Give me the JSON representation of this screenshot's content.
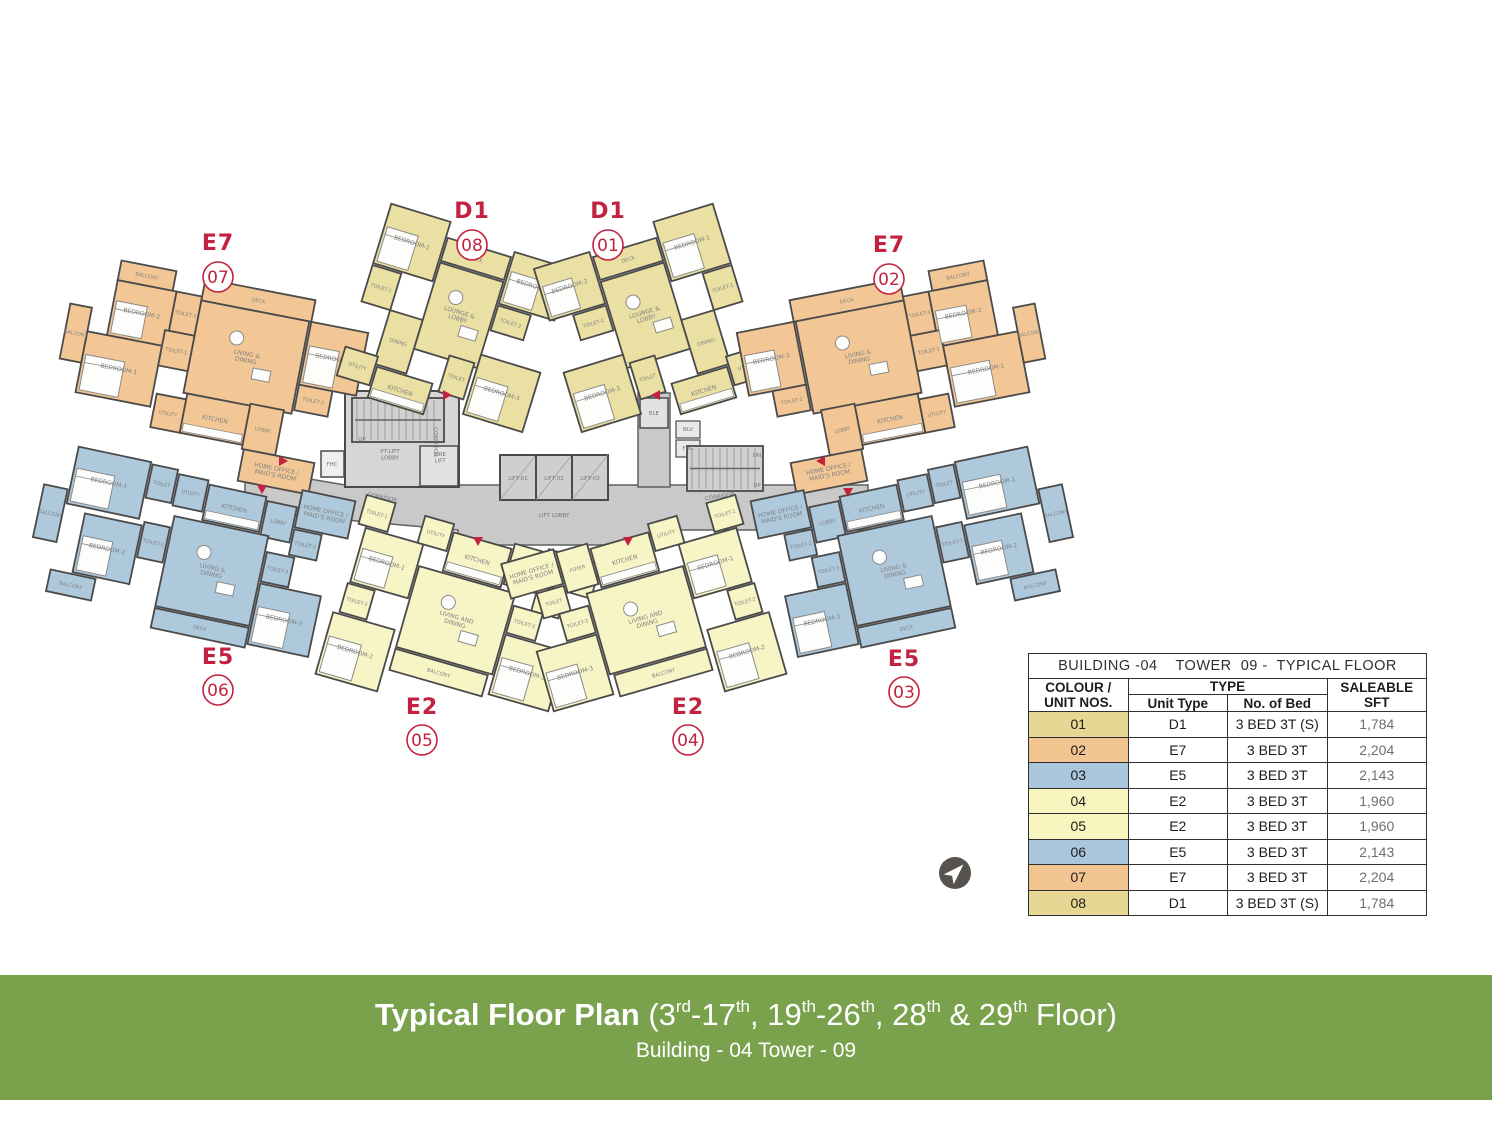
{
  "banner": {
    "bg": "#7aa24d",
    "heading_bold": "Typical Floor Plan ",
    "heading_parts": [
      {
        "t": "(3"
      },
      {
        "sup": "rd"
      },
      {
        "t": "-17"
      },
      {
        "sup": "th"
      },
      {
        "t": ", 19"
      },
      {
        "sup": "th"
      },
      {
        "t": "-26"
      },
      {
        "sup": "th"
      },
      {
        "t": ", 28"
      },
      {
        "sup": "th"
      },
      {
        "t": " & 29"
      },
      {
        "sup": "th"
      },
      {
        "t": " Floor)"
      }
    ],
    "subtitle": "Building - 04 Tower - 09"
  },
  "table": {
    "title": "BUILDING -04    TOWER  09 -  TYPICAL FLOOR",
    "header": {
      "col1_line1": "COLOUR /",
      "col1_line2": "UNIT NOS.",
      "type_group": "TYPE",
      "unit_type": "Unit Type",
      "no_of_bed": "No. of Bed",
      "saleable_line1": "SALEABLE",
      "saleable_line2": "SFT"
    },
    "rows": [
      {
        "unit": "01",
        "color": "#e7d795",
        "type": "D1",
        "bed": "3 BED 3T (S)",
        "sft": "1,784"
      },
      {
        "unit": "02",
        "color": "#f2c48f",
        "type": "E7",
        "bed": "3 BED 3T",
        "sft": "2,204"
      },
      {
        "unit": "03",
        "color": "#a9c6dc",
        "type": "E5",
        "bed": "3 BED 3T",
        "sft": "2,143"
      },
      {
        "unit": "04",
        "color": "#f8f5bf",
        "type": "E2",
        "bed": "3 BED 3T",
        "sft": "1,960"
      },
      {
        "unit": "05",
        "color": "#f8f5bf",
        "type": "E2",
        "bed": "3 BED 3T",
        "sft": "1,960"
      },
      {
        "unit": "06",
        "color": "#a9c6dc",
        "type": "E5",
        "bed": "3 BED 3T",
        "sft": "2,143"
      },
      {
        "unit": "07",
        "color": "#f2c48f",
        "type": "E7",
        "bed": "3 BED 3T",
        "sft": "2,204"
      },
      {
        "unit": "08",
        "color": "#e7d795",
        "type": "D1",
        "bed": "3 BED 3T (S)",
        "sft": "1,784"
      }
    ]
  },
  "plan": {
    "colors": {
      "wall": "#4a4a4a",
      "corridor": "#c9c9c9",
      "core": "#d6d6d6",
      "lift": "#cfcfcf",
      "stair": "#d0d0d0",
      "hatch": "#8f8f8f",
      "room_text": "#828282",
      "red": "#c22240",
      "compass": "#56524d"
    },
    "unit_colors": {
      "D1": "#eae0a3",
      "E7": "#f2c795",
      "E5": "#aec9dc",
      "E2": "#f7f4c6"
    },
    "room_layouts": {
      "E7": [
        [
          "BALCONY",
          -112,
          -102,
          56,
          20,
          ""
        ],
        [
          "BEDROOM-2",
          -112,
          -82,
          60,
          56,
          "bed"
        ],
        [
          "TOILET-3",
          -52,
          -82,
          26,
          40,
          ""
        ],
        [
          "DECK",
          -26,
          -100,
          112,
          22,
          ""
        ],
        [
          "LIVING &|DINING",
          -26,
          -78,
          110,
          94,
          "live"
        ],
        [
          "BEDROOM-3",
          86,
          -78,
          58,
          64,
          "bed"
        ],
        [
          "BALCONY",
          -154,
          -50,
          22,
          56,
          ""
        ],
        [
          "BEDROOM-1",
          -132,
          -26,
          76,
          62,
          "bed"
        ],
        [
          "TOILET-1",
          -56,
          -42,
          30,
          36,
          ""
        ],
        [
          "UTILITY",
          -52,
          22,
          30,
          34,
          ""
        ],
        [
          "KITCHEN",
          -22,
          16,
          64,
          40,
          "kit"
        ],
        [
          "LOBBY",
          42,
          14,
          34,
          46,
          ""
        ],
        [
          "TOILET-2",
          86,
          -14,
          34,
          26,
          ""
        ],
        [
          "HOME OFFICE /|MAID'S ROOM",
          44,
          60,
          72,
          32,
          ""
        ]
      ],
      "D1": [
        [
          "BEDROOM-1",
          -112,
          -104,
          62,
          62,
          "bed"
        ],
        [
          "TOILET-1",
          -112,
          -40,
          30,
          38,
          ""
        ],
        [
          "DECK",
          -48,
          -88,
          66,
          24,
          ""
        ],
        [
          "BEDROOM-2",
          20,
          -94,
          58,
          54,
          "bed"
        ],
        [
          "LOUNGE &|LOBBY",
          -48,
          -62,
          66,
          90,
          "live"
        ],
        [
          "TOILET-2",
          20,
          -38,
          34,
          26,
          ""
        ],
        [
          "DINING",
          -82,
          -2,
          34,
          56,
          ""
        ],
        [
          "BEDROOM-3",
          18,
          14,
          62,
          62,
          "bed"
        ],
        [
          "TOILET",
          -12,
          24,
          26,
          38,
          ""
        ],
        [
          "KITCHEN",
          -78,
          56,
          58,
          32,
          "kit"
        ],
        [
          "UTILITY",
          -114,
          46,
          34,
          30,
          ""
        ]
      ],
      "E5": [
        [
          "BEDROOM-1",
          -150,
          -84,
          74,
          58,
          "bed"
        ],
        [
          "TOILET",
          -74,
          -82,
          26,
          34,
          ""
        ],
        [
          "UTILITY",
          -46,
          -78,
          30,
          32,
          ""
        ],
        [
          "KITCHEN",
          -14,
          -74,
          58,
          36,
          "kit"
        ],
        [
          "LOBBY",
          46,
          -70,
          30,
          36,
          ""
        ],
        [
          "HOME OFFICE /|MAID'S ROOM",
          78,
          -88,
          54,
          38,
          ""
        ],
        [
          "TOILET-2",
          78,
          -48,
          28,
          26,
          ""
        ],
        [
          "BALCONY",
          -176,
          -40,
          24,
          54,
          ""
        ],
        [
          "BEDROOM-2",
          -130,
          -20,
          58,
          60,
          "bed"
        ],
        [
          "TOILET-1",
          -70,
          -24,
          26,
          36,
          ""
        ],
        [
          "LIVING &|DINING",
          -42,
          -36,
          96,
          92,
          "live"
        ],
        [
          "TOILET-3",
          56,
          -20,
          28,
          30,
          ""
        ],
        [
          "BEDROOM-3",
          56,
          12,
          62,
          62,
          "bed"
        ],
        [
          "BALCONY",
          -152,
          42,
          46,
          22,
          ""
        ],
        [
          "DECK",
          -42,
          58,
          96,
          20,
          ""
        ]
      ],
      "E2": [
        [
          "TOILET-1",
          -126,
          -94,
          30,
          30,
          ""
        ],
        [
          "BEDROOM-1",
          -118,
          -62,
          60,
          56,
          "bed"
        ],
        [
          "UTILITY",
          -64,
          -90,
          30,
          28,
          ""
        ],
        [
          "KITCHEN",
          -32,
          -82,
          60,
          40,
          "kit"
        ],
        [
          "FOYER",
          30,
          -88,
          32,
          42,
          ""
        ],
        [
          "HOME OFFICE /|MAID'S ROOM",
          64,
          -92,
          54,
          36,
          ""
        ],
        [
          "TOILET",
          64,
          -54,
          28,
          26,
          ""
        ],
        [
          "LIVING AND|DINING",
          -56,
          -40,
          100,
          84,
          "live"
        ],
        [
          "TOILET-3",
          46,
          -28,
          30,
          28,
          ""
        ],
        [
          "BEDROOM-3",
          46,
          2,
          62,
          62,
          "bed"
        ],
        [
          "TOILET-2",
          -120,
          -4,
          28,
          30,
          ""
        ],
        [
          "BEDROOM-2",
          -126,
          28,
          64,
          64,
          "bed"
        ],
        [
          "BALCONY",
          -56,
          46,
          96,
          22,
          ""
        ]
      ]
    },
    "units": [
      {
        "id": "07",
        "type": "E7",
        "cx": 212,
        "cy": 382,
        "rot": 11,
        "mirror": false,
        "label_x": 218,
        "label_y": 250,
        "circ_x": 218,
        "circ_y": 277
      },
      {
        "id": "08",
        "type": "D1",
        "cx": 468,
        "cy": 336,
        "rot": 17,
        "mirror": false,
        "label_x": 472,
        "label_y": 218,
        "circ_x": 472,
        "circ_y": 245
      },
      {
        "id": "01",
        "type": "D1",
        "cx": 636,
        "cy": 336,
        "rot": -17,
        "mirror": true,
        "label_x": 608,
        "label_y": 218,
        "circ_x": 608,
        "circ_y": 245
      },
      {
        "id": "02",
        "type": "E7",
        "cx": 893,
        "cy": 382,
        "rot": -11,
        "mirror": true,
        "label_x": 889,
        "label_y": 252,
        "circ_x": 889,
        "circ_y": 279
      },
      {
        "id": "06",
        "type": "E5",
        "cx": 208,
        "cy": 560,
        "rot": 12,
        "mirror": false,
        "label_x": 218,
        "label_y": 664,
        "circ_x": 218,
        "circ_y": 690
      },
      {
        "id": "05",
        "type": "E2",
        "cx": 462,
        "cy": 620,
        "rot": 16,
        "mirror": false,
        "label_x": 422,
        "label_y": 714,
        "circ_x": 422,
        "circ_y": 740
      },
      {
        "id": "04",
        "type": "E2",
        "cx": 640,
        "cy": 620,
        "rot": -16,
        "mirror": true,
        "label_x": 688,
        "label_y": 714,
        "circ_x": 688,
        "circ_y": 740
      },
      {
        "id": "03",
        "type": "E5",
        "cx": 898,
        "cy": 560,
        "rot": -12,
        "mirror": true,
        "label_x": 904,
        "label_y": 666,
        "circ_x": 904,
        "circ_y": 692
      }
    ],
    "core_labels": [
      {
        "t": "CORRIDOR",
        "x": 382,
        "y": 499,
        "r": 12
      },
      {
        "t": "CORRIDOR",
        "x": 434,
        "y": 442,
        "r": 90
      },
      {
        "t": "CORRIDOR",
        "x": 720,
        "y": 498,
        "r": -9
      },
      {
        "t": "LIFT LOBBY",
        "x": 554,
        "y": 517,
        "r": 0
      },
      {
        "t": "LIFT-01",
        "x": 518,
        "y": 480,
        "r": 0
      },
      {
        "t": "LIFT-02",
        "x": 554,
        "y": 480,
        "r": 0
      },
      {
        "t": "LIFT-03",
        "x": 590,
        "y": 480,
        "r": 0
      },
      {
        "t": "PT-LIFT|LOBBY",
        "x": 390,
        "y": 456,
        "r": 0
      },
      {
        "t": "FIRE|LIFT",
        "x": 440,
        "y": 459,
        "r": 0
      },
      {
        "t": "UP",
        "x": 362,
        "y": 441,
        "r": 0
      },
      {
        "t": "FHC",
        "x": 332,
        "y": 466,
        "r": 0
      },
      {
        "t": "DN",
        "x": 757,
        "y": 457,
        "r": 0
      },
      {
        "t": "UP",
        "x": 757,
        "y": 487,
        "r": 0
      },
      {
        "t": "ELE",
        "x": 654,
        "y": 415,
        "r": 0
      },
      {
        "t": "BLV",
        "x": 688,
        "y": 431,
        "r": 0
      },
      {
        "t": "FHC",
        "x": 688,
        "y": 450,
        "r": 0
      }
    ],
    "arrows": [
      {
        "x": 262,
        "y": 489,
        "d": "d"
      },
      {
        "x": 283,
        "y": 461,
        "d": "r"
      },
      {
        "x": 447,
        "y": 395,
        "d": "r"
      },
      {
        "x": 656,
        "y": 395,
        "d": "l"
      },
      {
        "x": 821,
        "y": 461,
        "d": "l"
      },
      {
        "x": 478,
        "y": 541,
        "d": "d"
      },
      {
        "x": 628,
        "y": 541,
        "d": "d"
      },
      {
        "x": 848,
        "y": 492,
        "d": "d"
      }
    ]
  }
}
